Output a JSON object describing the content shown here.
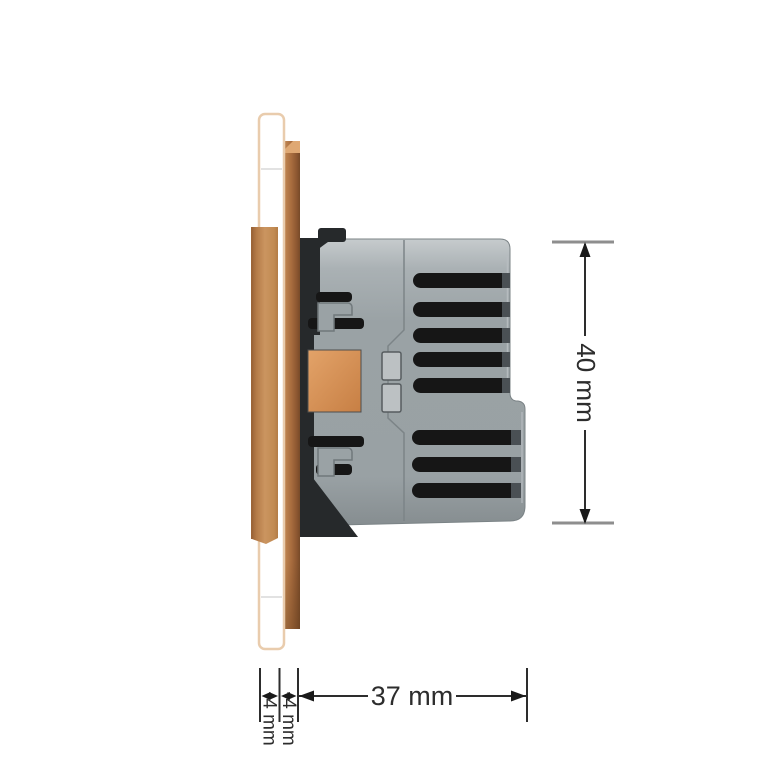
{
  "drawing": {
    "subject": "glass-panel-wall-module-side-view",
    "labels": {
      "height": "40 mm",
      "depth": "37 mm",
      "glass_thickness": "4 mm",
      "frame_thickness": "4 mm"
    },
    "colors": {
      "background": "#ffffff",
      "glass_fill": "#ffffff",
      "glass_border": "#e9ccad",
      "frame_brown_mid": "#b5784a",
      "frame_brown_dark": "#7e4f2b",
      "strip_brown": "#c9935f",
      "body_gray": "#9aa2a5",
      "body_gray_light": "#c6cbcd",
      "body_gray_dark": "#82898c",
      "vent_black": "#161616",
      "claw_black": "#26292b",
      "terminal_orange": "#cf8a52",
      "button_gray": "#bcc1c3",
      "button_border": "#565c5f",
      "dimension_line": "#2d2d2d",
      "tick_gray": "#8e8e8e"
    }
  }
}
